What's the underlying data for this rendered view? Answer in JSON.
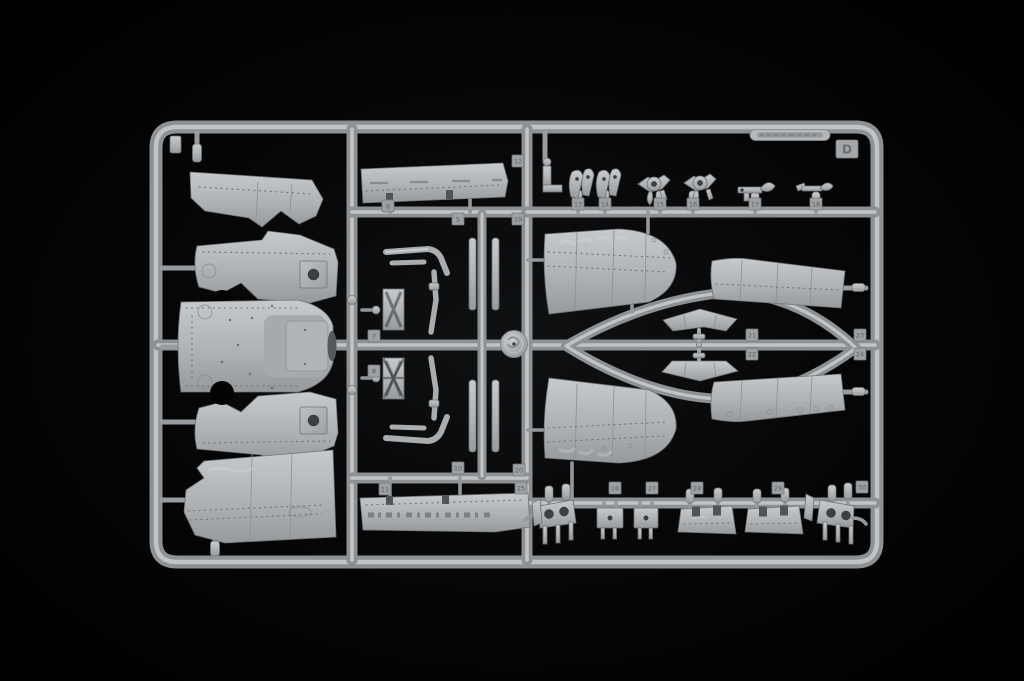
{
  "sprue": {
    "letter_tag": "D",
    "colors": {
      "background": "#050505",
      "plastic_mid": "#aeb2b4",
      "plastic_light": "#cdd1d3",
      "plastic_shadow": "#7e8284",
      "tag_fill": "#9da1a3",
      "tag_text": "#5a5e60"
    },
    "part_tags": [
      {
        "label": "6",
        "x": 388,
        "y": 206
      },
      {
        "label": "5",
        "x": 458,
        "y": 219
      },
      {
        "label": "12",
        "x": 518,
        "y": 161
      },
      {
        "label": "19",
        "x": 518,
        "y": 219
      },
      {
        "label": "13",
        "x": 578,
        "y": 204
      },
      {
        "label": "14",
        "x": 605,
        "y": 204
      },
      {
        "label": "15",
        "x": 660,
        "y": 204
      },
      {
        "label": "16",
        "x": 693,
        "y": 204
      },
      {
        "label": "17",
        "x": 755,
        "y": 204
      },
      {
        "label": "18",
        "x": 816,
        "y": 204
      },
      {
        "label": "7",
        "x": 374,
        "y": 336
      },
      {
        "label": "8",
        "x": 374,
        "y": 371
      },
      {
        "label": "21",
        "x": 752,
        "y": 335
      },
      {
        "label": "22",
        "x": 752,
        "y": 354
      },
      {
        "label": "23",
        "x": 860,
        "y": 335
      },
      {
        "label": "24",
        "x": 860,
        "y": 354
      },
      {
        "label": "10",
        "x": 458,
        "y": 468
      },
      {
        "label": "20",
        "x": 519,
        "y": 470
      },
      {
        "label": "11",
        "x": 385,
        "y": 489
      },
      {
        "label": "25",
        "x": 521,
        "y": 488
      },
      {
        "label": "26",
        "x": 615,
        "y": 488
      },
      {
        "label": "27",
        "x": 652,
        "y": 488
      },
      {
        "label": "28",
        "x": 697,
        "y": 488
      },
      {
        "label": "29",
        "x": 778,
        "y": 488
      },
      {
        "label": "30",
        "x": 862,
        "y": 487
      }
    ]
  }
}
